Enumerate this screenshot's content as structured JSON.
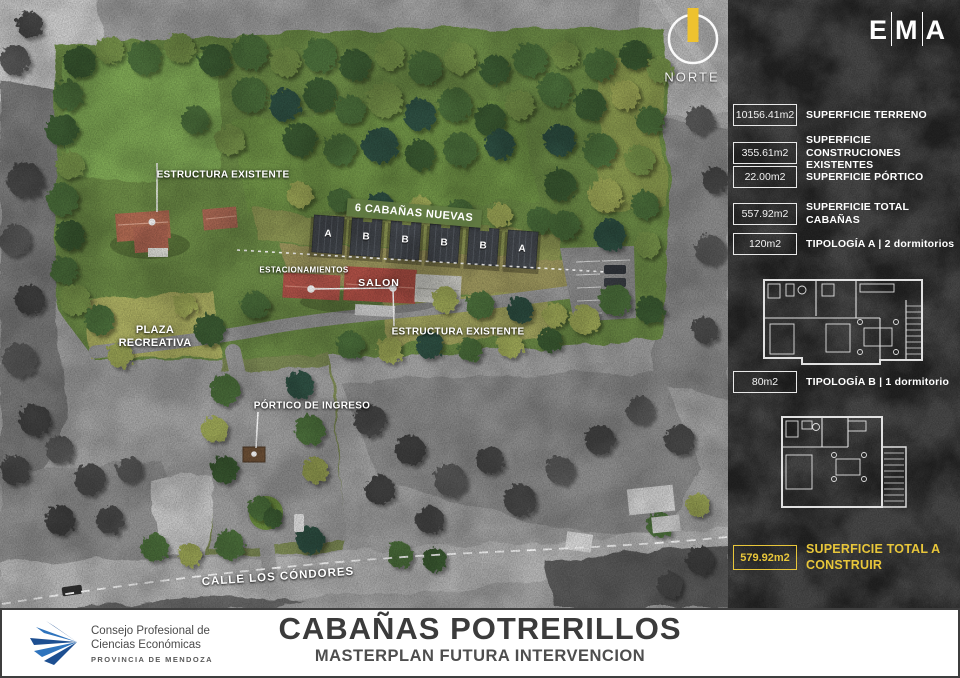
{
  "header": {
    "logo": {
      "letters": [
        "E",
        "M",
        "A"
      ]
    }
  },
  "north": {
    "label": "NORTE"
  },
  "map": {
    "labels": {
      "estructura_existente_top": "ESTRUCTURA EXISTENTE",
      "cabanas_banner": "6 CABAÑAS NUEVAS",
      "estacionamientos": "ESTACIONAMIENTOS",
      "salon": "SALON",
      "plaza_recreativa": "PLAZA\nRECREATIVA",
      "estructura_existente_bottom": "ESTRUCTURA EXISTENTE",
      "portico_de_ingreso": "PÓRTICO DE INGRESO",
      "calle": "CALLE LOS CÓNDORES"
    },
    "cabins": [
      "A",
      "B",
      "B",
      "B",
      "B",
      "A"
    ]
  },
  "sidebar": {
    "rows": [
      {
        "value": "10156.41m2",
        "label": "SUPERFICIE TERRENO"
      },
      {
        "value": "355.61m2",
        "label": "SUPERFICIE CONSTRUCIONES EXISTENTES"
      },
      {
        "value": "22.00m2",
        "label": "SUPERFICIE PÓRTICO"
      },
      {
        "value": "557.92m2",
        "label": "SUPERFICIE TOTAL CABAÑAS"
      },
      {
        "value": "120m2",
        "label": "TIPOLOGÍA A | 2 dormitorios"
      },
      {
        "value": "80m2",
        "label": "TIPOLOGÍA B | 1 dormitorio"
      }
    ],
    "total": {
      "value": "579.92m2",
      "label": "SUPERFICIE TOTAL A CONSTRUIR"
    }
  },
  "footer": {
    "org": {
      "line1": "Consejo Profesional de",
      "line2": "Ciencias Económicas",
      "line3": "PROVINCIA DE MENDOZA"
    },
    "title": "CABAÑAS POTRERILLOS",
    "subtitle": "MASTERPLAN FUTURA INTERVENCION"
  },
  "colors": {
    "accent_yellow": "#e8c63a",
    "banner_green": "#617a42",
    "logo_blue": "#1d5a9e"
  }
}
